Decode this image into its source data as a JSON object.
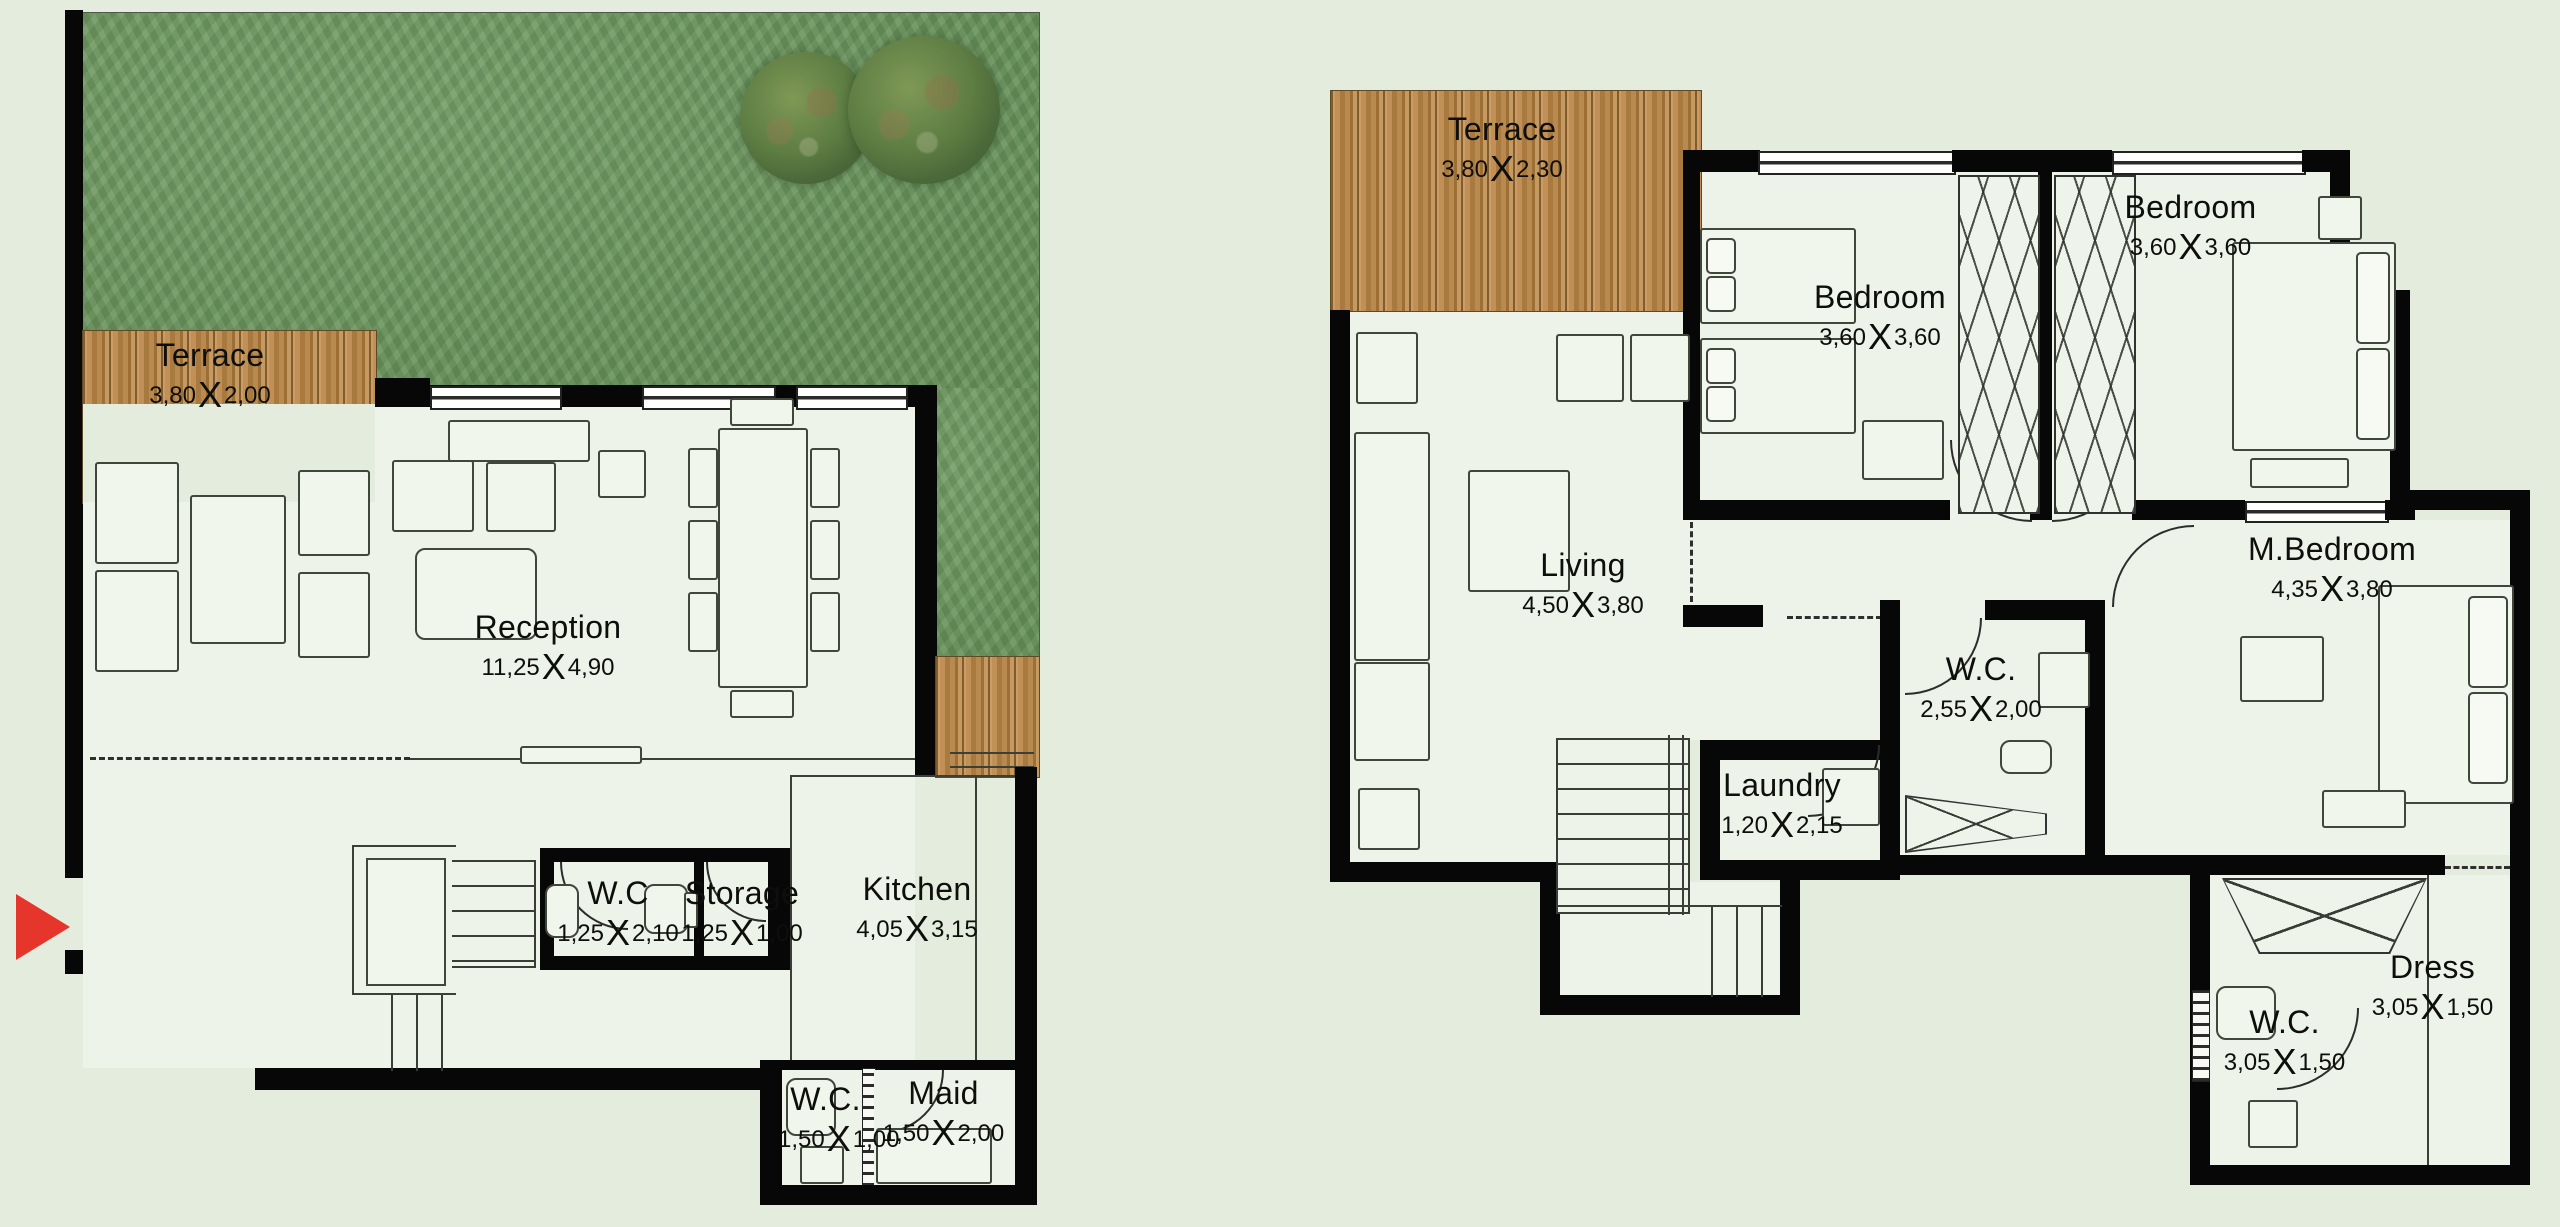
{
  "sep": {
    "x": "X"
  },
  "colors": {
    "page_background": "#e3ecdd",
    "floor": "#edf3e8",
    "wall": "#070707",
    "grass": "#6f9a61",
    "terrace_wood": "#b5854c",
    "entrance_arrow": "#e6352b"
  },
  "ground": {
    "terrace": {
      "name": "Terrace",
      "w": "3,80",
      "h": "2,00"
    },
    "reception": {
      "name": "Reception",
      "w": "11,25",
      "h": "4,90"
    },
    "wc": {
      "name": "W.C",
      "w": "1,25",
      "h": "2,10"
    },
    "storage": {
      "name": "Storage",
      "w": "1,25",
      "h": "1,00"
    },
    "kitchen": {
      "name": "Kitchen",
      "w": "4,05",
      "h": "3,15"
    },
    "wc2": {
      "name": "W.C.",
      "w": "1,50",
      "h": "1,00"
    },
    "maid": {
      "name": "Maid",
      "w": "1,50",
      "h": "2,00"
    }
  },
  "first": {
    "terrace": {
      "name": "Terrace",
      "w": "3,80",
      "h": "2,30"
    },
    "bedroom1": {
      "name": "Bedroom",
      "w": "3,60",
      "h": "3,60"
    },
    "bedroom2": {
      "name": "Bedroom",
      "w": "3,60",
      "h": "3,60"
    },
    "living": {
      "name": "Living",
      "w": "4,50",
      "h": "3,80"
    },
    "wc": {
      "name": "W.C.",
      "w": "2,55",
      "h": "2,00"
    },
    "laundry": {
      "name": "Laundry",
      "w": "1,20",
      "h": "2,15"
    },
    "mbedroom": {
      "name": "M.Bedroom",
      "w": "4,35",
      "h": "3,80"
    },
    "wc2": {
      "name": "W.C.",
      "w": "3,05",
      "h": "1,50"
    },
    "dress": {
      "name": "Dress",
      "w": "3,05",
      "h": "1,50"
    }
  }
}
